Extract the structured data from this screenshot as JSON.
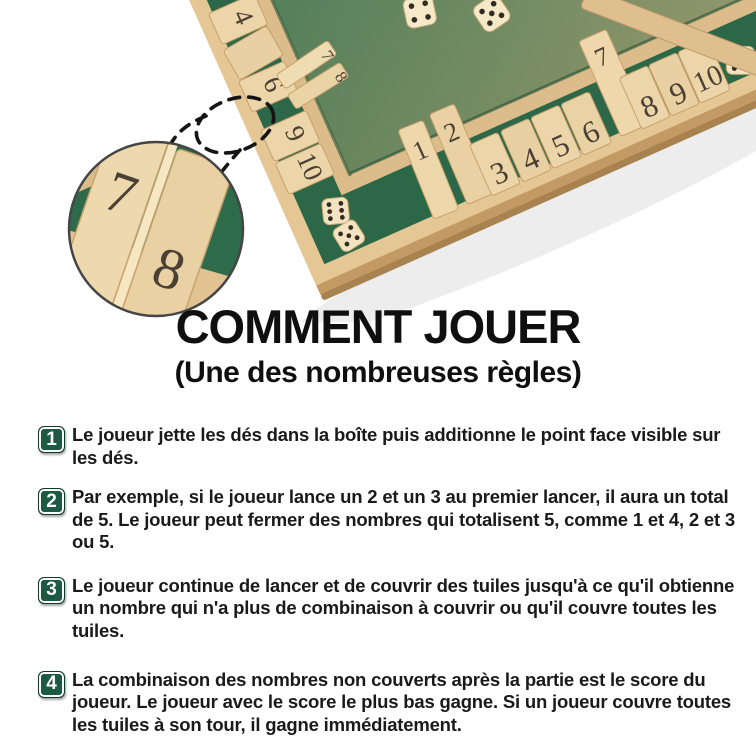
{
  "title": {
    "main": "COMMENT JOUER",
    "subtitle": "(Une des nombreuses règles)"
  },
  "steps": [
    {
      "number": "1",
      "text": "Le joueur jette les dés dans la boîte puis additionne le point face visible sur les dés."
    },
    {
      "number": "2",
      "text": "Par exemple, si le joueur lance un 2 et un 3 au premier lancer, il aura un total de 5. Le joueur peut fermer des nombres qui totalisent 5, comme 1 et 4, 2 et 3 ou 5."
    },
    {
      "number": "3",
      "text": "Le joueur continue de lancer et de couvrir des tuiles jusqu'à ce qu'il obtienne un nombre qui n'a plus de combinaison à couvrir ou qu'il couvre toutes les tuiles."
    },
    {
      "number": "4",
      "text": "La combinaison des nombres non couverts après la partie est le score du joueur. Le joueur avec le score le plus bas gagne. Si un joueur couvre toutes les tuiles à son tour, il gagne immédiatement."
    }
  ],
  "photo": {
    "board": {
      "left_rail_tiles": [
        "4",
        "6",
        "9",
        "10"
      ],
      "left_standing_tiles": [
        "7",
        "8"
      ],
      "bottom_standing_tiles": [
        "1",
        "2"
      ],
      "bottom_flat_tiles_left": [
        "3",
        "4",
        "5",
        "6"
      ],
      "bottom_standing_seven": "7",
      "bottom_flat_tiles_right": [
        "8",
        "9",
        "10"
      ]
    },
    "inset": {
      "tiles": [
        "7",
        "8"
      ]
    },
    "dice_pips": [
      4,
      5,
      6,
      5,
      6
    ]
  },
  "colors": {
    "badge_green": "#1d5a44",
    "felt_green": "#2e6b4b",
    "wood": "#e2c392",
    "text": "#1a1a1a"
  }
}
